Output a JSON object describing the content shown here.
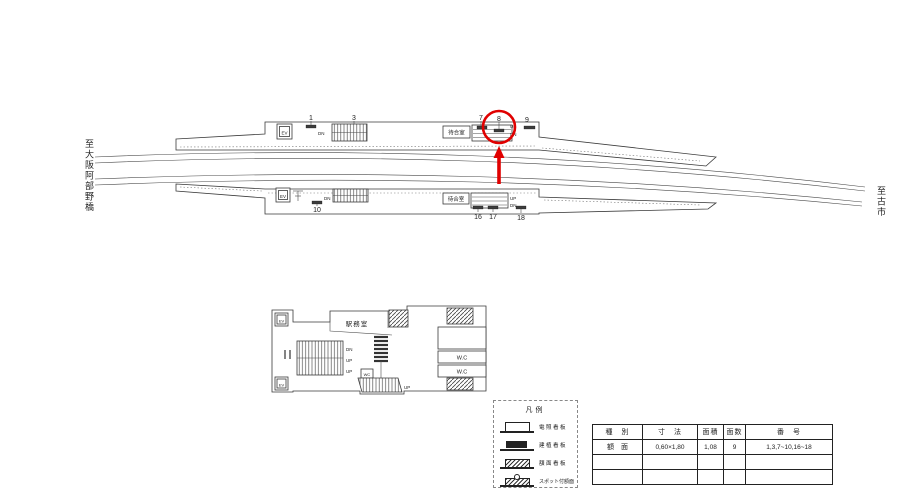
{
  "page": {
    "background": "#ffffff",
    "line_color": "#3a3a3a",
    "highlight_color": "#e00000"
  },
  "endpoints": {
    "left": "至大阪阿部野橋",
    "right": "至古市"
  },
  "upper_platform": {
    "ev": "EV",
    "pos_1": "1",
    "pos_3": "3",
    "pos_7": "7",
    "pos_8": "8",
    "pos_9": "9",
    "dn_left": "DN",
    "waiting_room": "待合室",
    "up_right": "UP",
    "dn_right": "DN"
  },
  "lower_platform": {
    "ev": "EV",
    "pos_10": "10",
    "pos_16": "16",
    "pos_17": "17",
    "pos_18": "18",
    "dn_left": "DN",
    "waiting_room": "待合室",
    "up_right": "UP",
    "dn_right": "DN"
  },
  "concourse": {
    "office": "駅務室",
    "ev": "EV",
    "dn": "DN",
    "up_mid": "UP",
    "up_low": "UP",
    "wc_small": "WC",
    "up_stairs": "UP",
    "wc_room_1": "W.C",
    "wc_room_2": "W.C"
  },
  "highlight": {
    "circled_position": "8"
  },
  "legend": {
    "title": "凡例",
    "items": [
      {
        "label": "電照看板",
        "symbol": "lightbox"
      },
      {
        "label": "建植看板",
        "symbol": "solid"
      },
      {
        "label": "額面看板",
        "symbol": "hatched"
      },
      {
        "label": "スポット付額面",
        "symbol": "hatched-spot"
      }
    ]
  },
  "spec_table": {
    "headers": [
      "種　別",
      "寸　法",
      "面積",
      "面数",
      "番　号"
    ],
    "rows": [
      [
        "額　面",
        "0,60×1,80",
        "1,08",
        "9",
        "1,3,7~10,16~18"
      ],
      [
        "",
        "",
        "",
        "",
        ""
      ],
      [
        "",
        "",
        "",
        "",
        ""
      ]
    ]
  }
}
